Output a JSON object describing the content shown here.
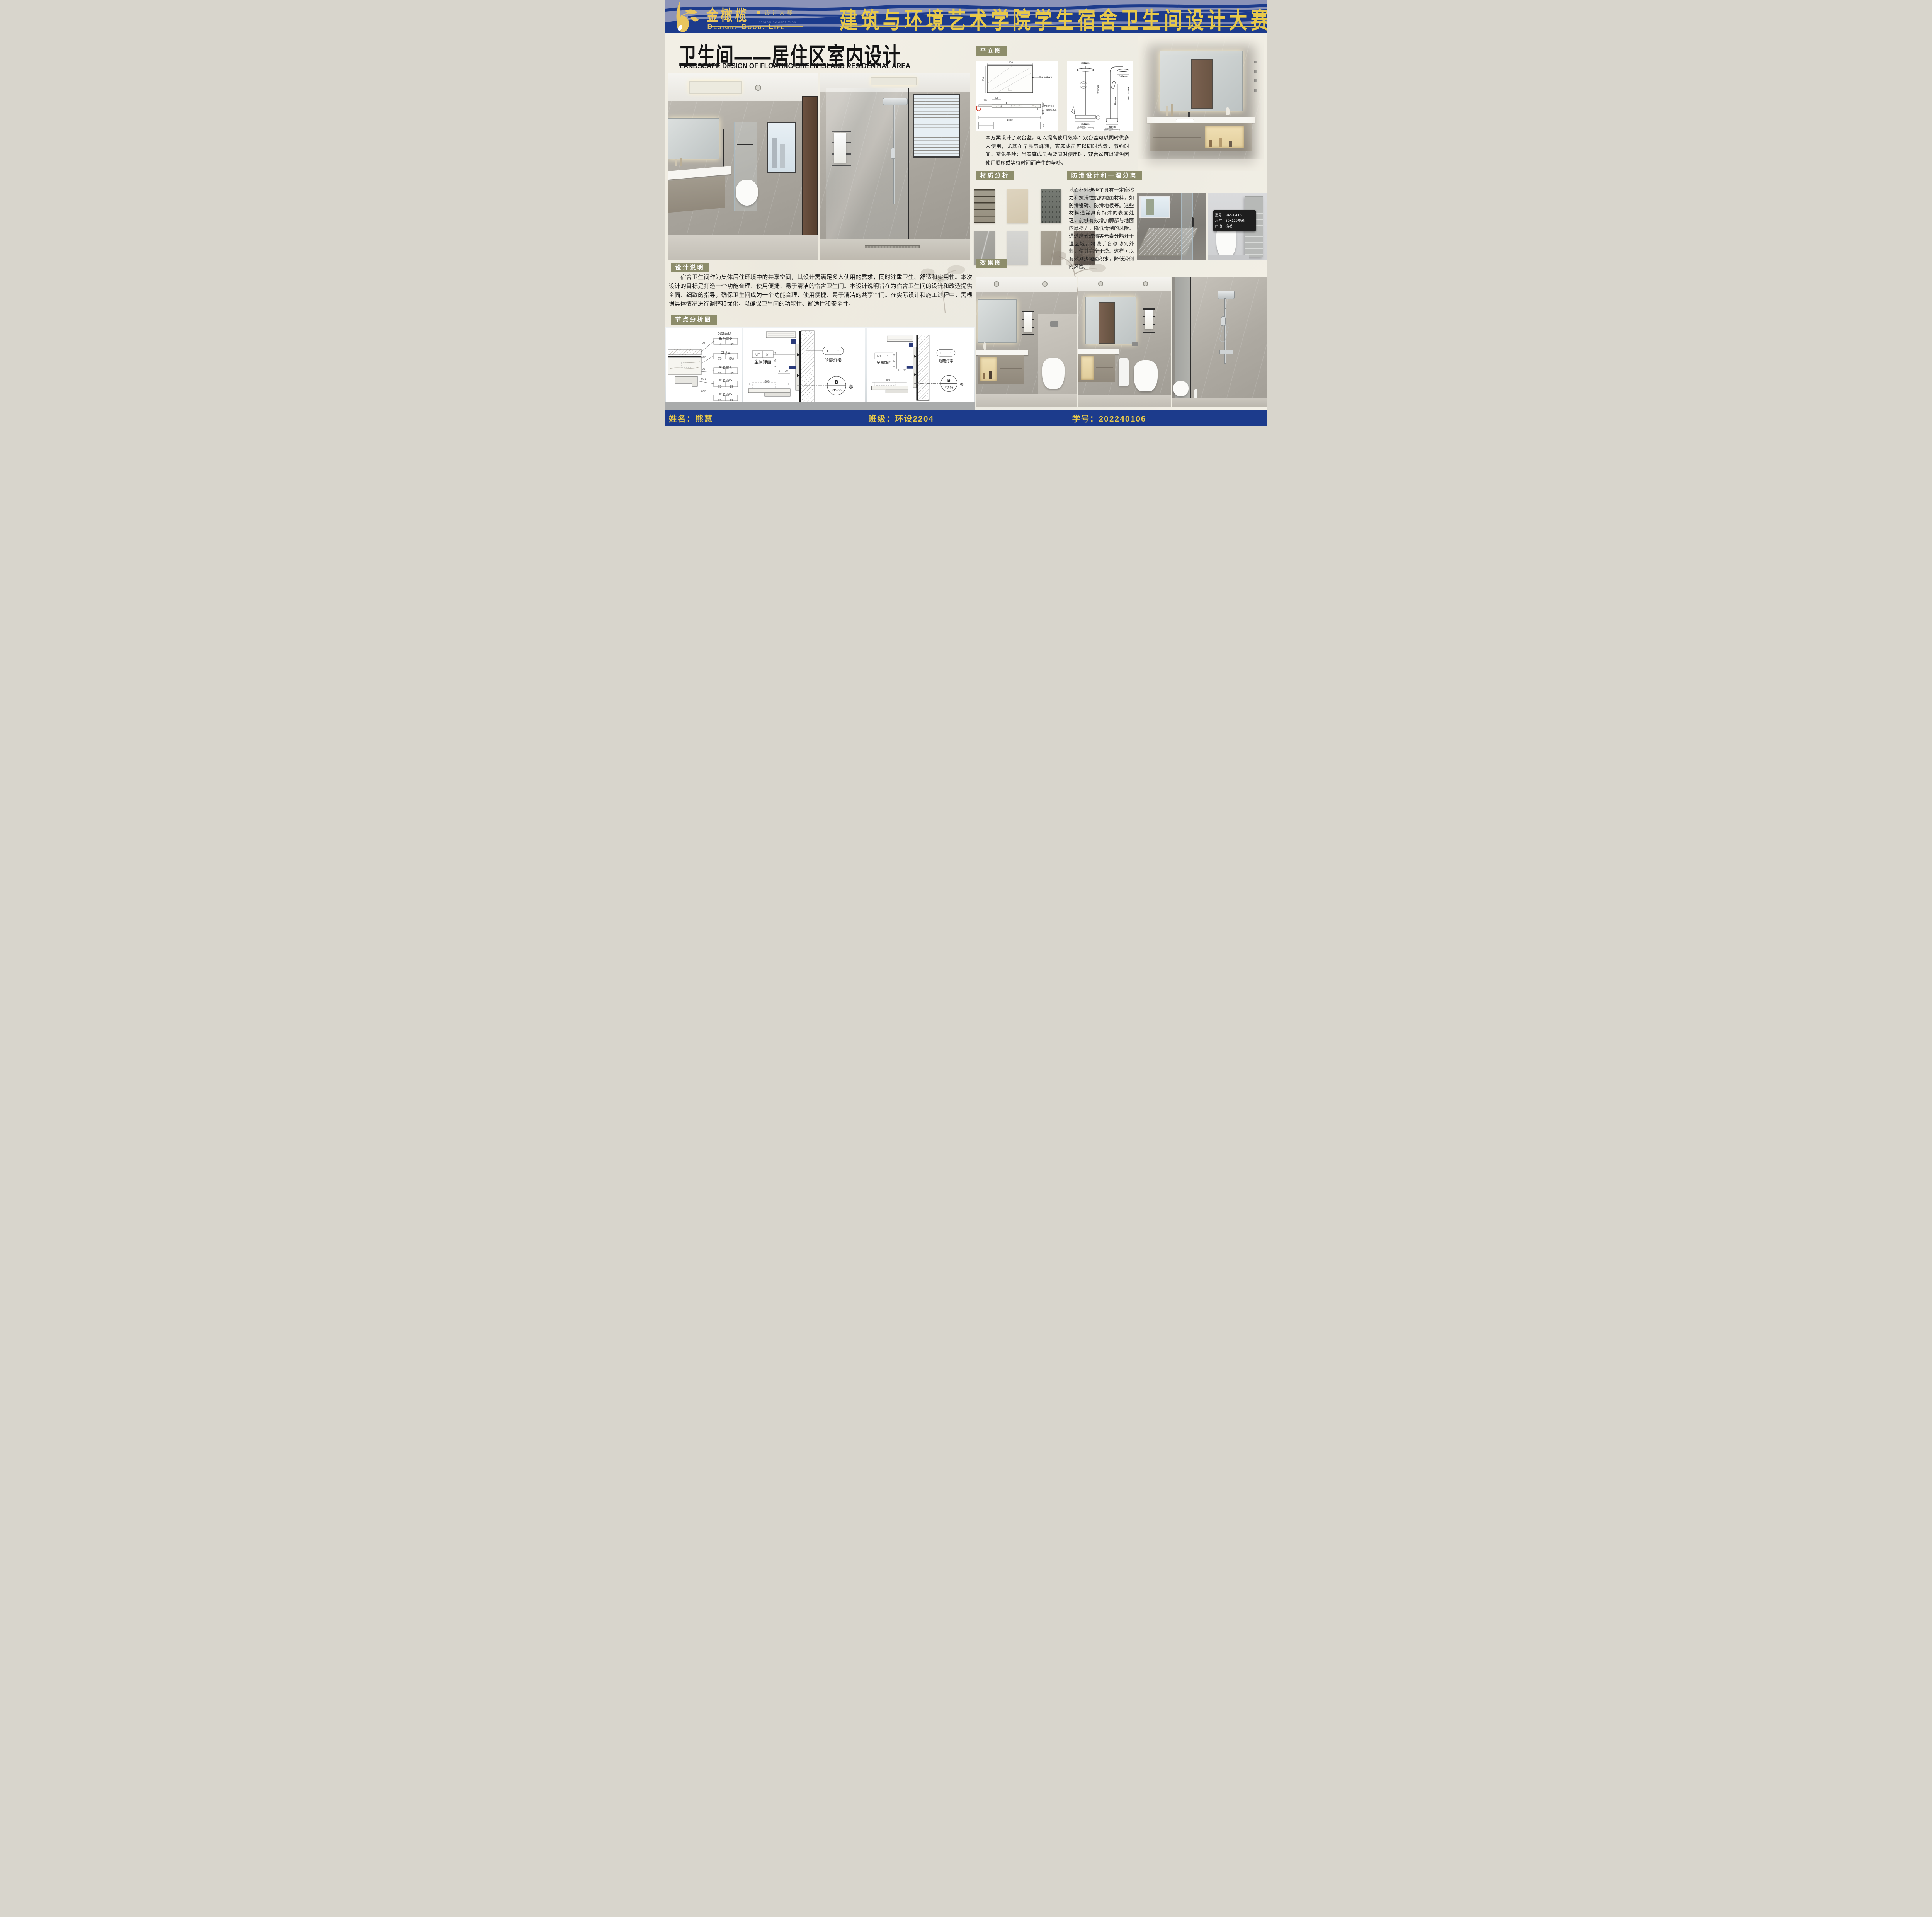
{
  "header": {
    "competition_title": "建筑与环境艺术学院学生宿舍卫生间设计大赛",
    "logo": {
      "name_cn": "金橄榄",
      "name_sub": "设计大赛",
      "sub_en": "DESIGN COMPETITION",
      "tagline": "Design.  Good.  Life"
    }
  },
  "main_title": {
    "cn": "卫生间——居住区室内设计",
    "en": "LANDSCAPE DESIGN OF FLOATING GREEN ISLAND RESIDENTIAL AREA"
  },
  "plan_section": {
    "label": "平立图",
    "mirror_width": "1400",
    "mirror_height": "900",
    "mirror_note": "黑色边框背光",
    "counter_dims": [
      "400",
      "325",
      "560",
      "180",
      "1845",
      "300"
    ],
    "counter_note_1": "鱼肚白岩板",
    "counter_note_2": "三面倒斜边小",
    "shower_dims": [
      "260mm",
      "260mm",
      "250mm",
      "(非数显款220mm)",
      "260mm",
      "780mm",
      "800-1100mm",
      "90mm",
      "(非数显款80mm)"
    ],
    "description": "本方案设计了双台盆，可以提高使用效率：双台盆可以同时供多人使用，尤其在早晨高峰期，家庭成员可以同时洗漱，节约时间。避免争吵：当家庭成员需要同时使用时，双台盆可以避免因使用顺序或等待时间而产生的争吵。"
  },
  "materials_section": {
    "label": "材质分析",
    "swatch_colors": [
      "#9f9a8b",
      "#d9cfba",
      "#72766f",
      "#c8c8c3",
      "#a5a49e",
      "#d2d2cf",
      "#a19b8d",
      "#696059"
    ]
  },
  "antislip_section": {
    "label": "防滑设计和干湿分离",
    "description": "地面材料选择了具有一定摩擦力和抗滑性能的地面材料，如防滑瓷砖、防滑地板等。这些材料通常具有特殊的表面处理，能够有效增加脚部与地面的摩擦力，降低滑倒的风险。通过磨砂玻璃等元素分隔开干湿区域，将洗手台移动到外部，使其完全干燥。这样可以有效减少地面积水，降低滑倒的风险。",
    "spec_card": {
      "model": "型号：HFS12603",
      "size": "尺寸：60X120厘米",
      "groove": "凹槽：横槽"
    }
  },
  "effects_section": {
    "label": "效果图"
  },
  "design_section": {
    "label": "设计说明",
    "description": "　　宿舍卫生间作为集体居住环境中的共享空间，其设计需满足多人使用的需求，同时注重卫生、舒适和实用性。本次设计的目标是打造一个功能合理、使用便捷、易于清洁的宿舍卫生间。本设计说明旨在为宿舍卫生间的设计和改造提供全面、细致的指导，确保卫生间成为一个功能合理、使用便捷、易于清洁的共享空间。在实际设计和施工过程中，需根据具体情况进行调整和优化，以确保卫生间的功能性、舒适性和安全性。"
  },
  "nodes_section": {
    "label": "节点分析图",
    "detail_a": {
      "note": "灯带暗线",
      "tags": [
        [
          "MT",
          "01",
          "金属饰面"
        ],
        [
          "WD",
          "02",
          "木饰面"
        ],
        [
          "MT",
          "01",
          "金属饰面"
        ],
        [
          "ST",
          "03",
          "石材饰面"
        ],
        [
          "ST",
          "03",
          "石材饰面"
        ]
      ],
      "dims": [
        "90",
        "250",
        "10",
        "150",
        "200"
      ]
    },
    "detail_b": {
      "tag": "MT",
      "tag_num": "01",
      "tag_label": "金属饰面",
      "light_tag": "L",
      "light_dash": "-",
      "light_label": "暗藏灯带",
      "ref_top": "B",
      "ref_bottom": "YD-05",
      "ref_side": "参",
      "dims": [
        "600",
        "70",
        "5"
      ],
      "vdims": [
        "15",
        "50",
        "5"
      ]
    }
  },
  "footer": {
    "name": "姓名：熊慧",
    "class_name": "班级：环设2204",
    "student_id": "学号：202240106"
  }
}
